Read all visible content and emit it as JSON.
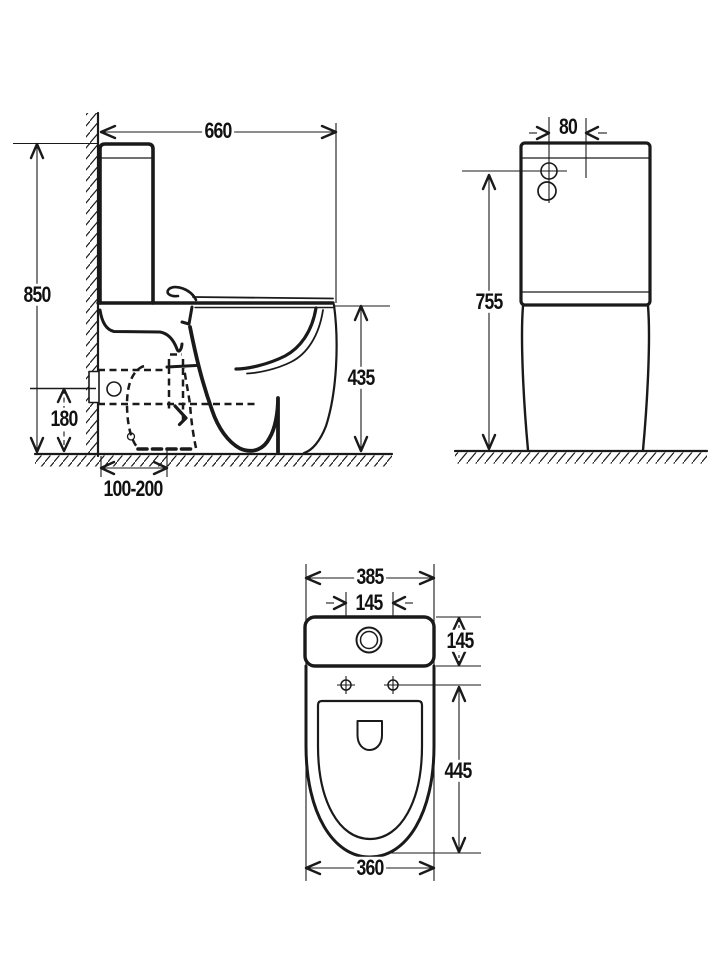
{
  "drawing": {
    "units_note": "",
    "line_color": "#1a1a1a",
    "background": "#ffffff",
    "dimensions": {
      "side_view": {
        "overall_depth": "660",
        "overall_height": "850",
        "seat_height": "435",
        "outlet_height": "180",
        "outlet_offset_range": "100-200"
      },
      "front_view": {
        "inlet_offset": "80",
        "inlet_height": "755"
      },
      "top_view": {
        "cistern_width": "385",
        "seat_bolt_spacing": "145",
        "cistern_depth": "145",
        "bowl_length": "445",
        "bowl_width": "360"
      }
    }
  }
}
